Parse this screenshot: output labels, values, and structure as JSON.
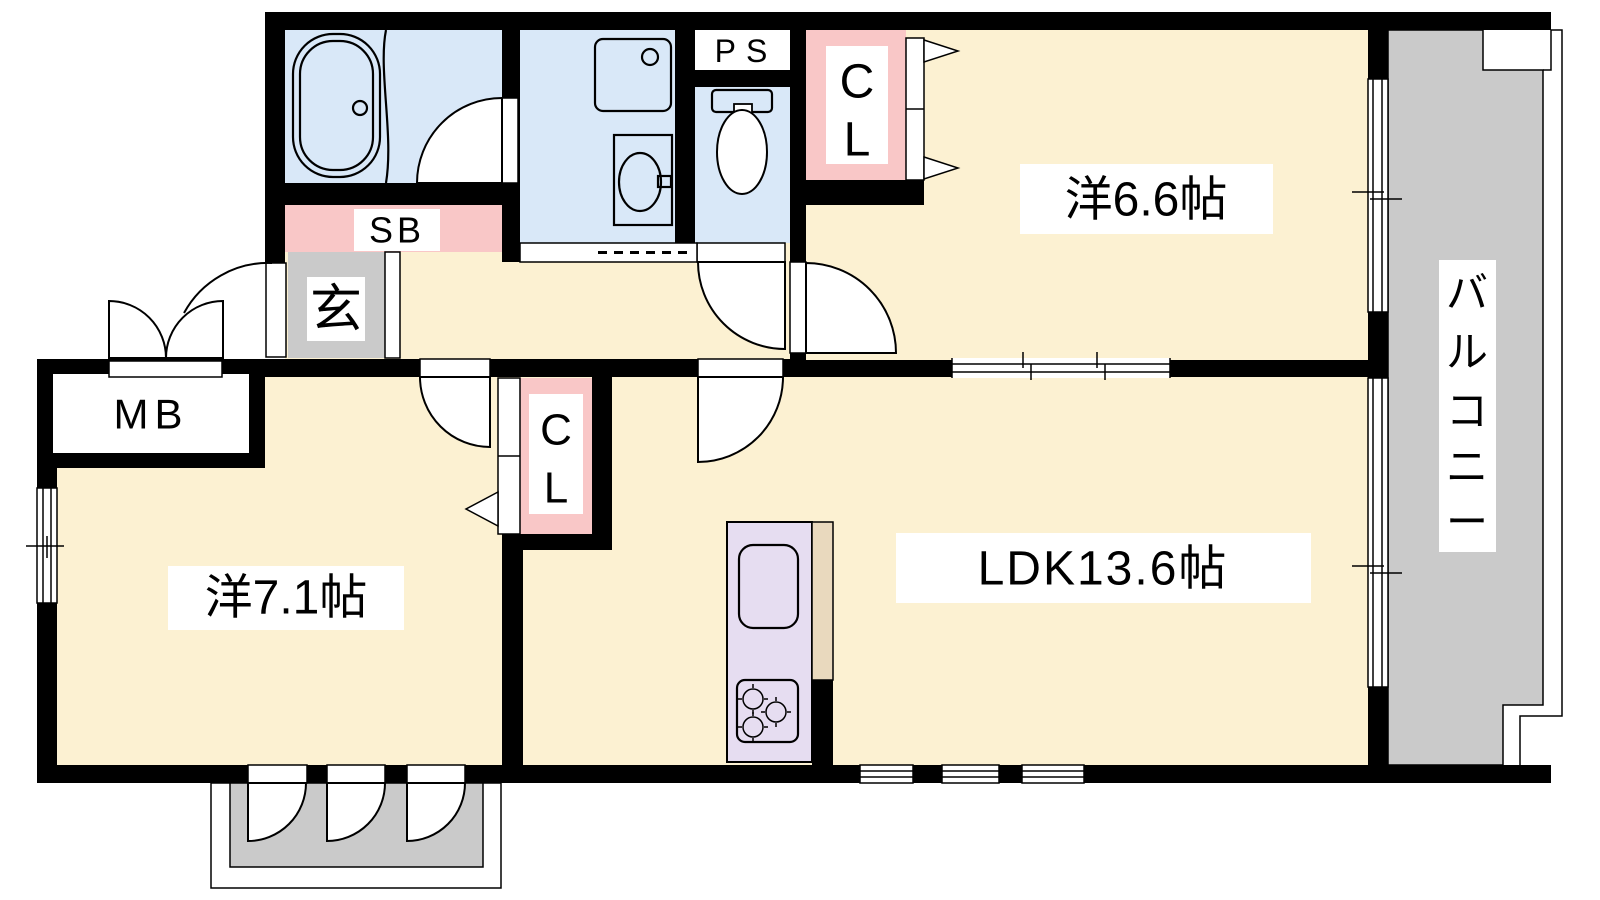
{
  "floorplan": {
    "rooms": {
      "bedroom_6_6": {
        "label": "洋6.6帖"
      },
      "bedroom_7_1": {
        "label": "洋7.1帖"
      },
      "ldk": {
        "label": "LDK13.6帖"
      },
      "balcony": {
        "chars": [
          "バ",
          "ル",
          "コ",
          "ニ",
          "ー"
        ]
      },
      "entrance": {
        "label": "玄"
      },
      "shoe_box": {
        "label": "SB"
      },
      "meter_box": {
        "label": "MB"
      },
      "pipe_space": {
        "label": "PS"
      },
      "closet_6_6": {
        "line1": "C",
        "line2": "L"
      },
      "closet_7_1": {
        "line1": "C",
        "line2": "L"
      }
    },
    "colors": {
      "floor": "#FCF1D2",
      "wet_area": "#D9E8F8",
      "closet": "#F9C7C7",
      "kitchen_counter": "#E6DDF1",
      "counter_edge": "#E9D9BE",
      "entrance_floor": "#CACACA",
      "balcony": "#CACACA",
      "wall": "#000000"
    }
  }
}
